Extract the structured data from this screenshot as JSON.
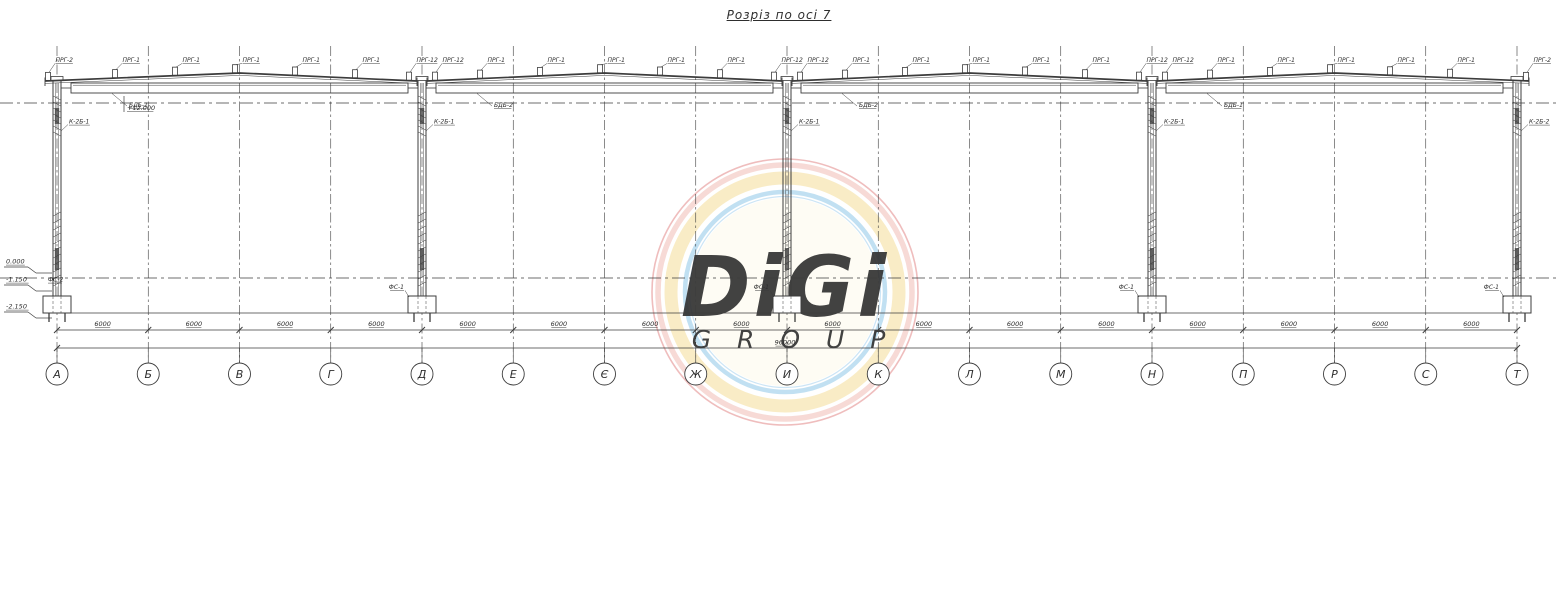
{
  "title": "Розріз по осі 7",
  "axes": {
    "labels": [
      "А",
      "Б",
      "В",
      "Г",
      "Д",
      "Е",
      "Є",
      "Ж",
      "И",
      "К",
      "Л",
      "М",
      "Н",
      "П",
      "Р",
      "С",
      "Т"
    ],
    "bay_dim": "6000",
    "total_dim": "96000"
  },
  "roof": {
    "purlin_end_label": "ПРГ-2",
    "purlin_main_label": "ПРГ-1",
    "purlin_at_column_label": "ПРГ-12",
    "level_mark": "+12.000",
    "beam_labels": [
      "БДБ-1",
      "БДБ-2",
      "БДБ-2",
      "БДБ-1"
    ]
  },
  "columns": {
    "column_axis_indices": [
      0,
      4,
      8,
      12,
      16
    ],
    "labels": [
      "К-2Б-1",
      "К-2Б-1",
      "К-2Б-1",
      "К-2Б-1",
      "К-2Б-2"
    ],
    "footing_labels": [
      "ФС-2",
      "ФС-1",
      "ФС-1",
      "ФС-1",
      "ФС-1"
    ]
  },
  "elevations": {
    "zero": "0.000",
    "minus_one": "-1.150",
    "minus_two": "-2.150"
  },
  "watermark": {
    "line1": "DiGi",
    "line2": "G R O U P",
    "ring_red": "#e07b7b",
    "ring_pink": "#f0b6ae",
    "ring_yellow": "#f5e0a0",
    "ring_blue": "#8ec6e8",
    "text_color": "#d6dade"
  },
  "line_color": "#3c3c3c"
}
